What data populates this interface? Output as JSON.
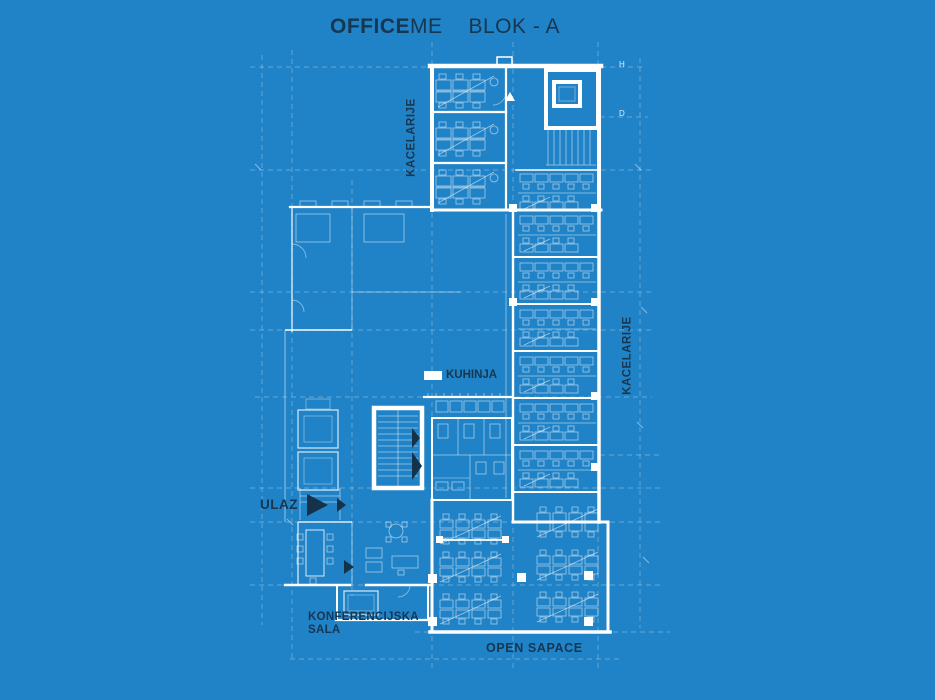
{
  "title": {
    "brand_bold": "OFFICE",
    "brand_regular": "ME",
    "block_name": "BLOK - A"
  },
  "labels": {
    "offices_top": "KACELARIJE",
    "offices_right": "KACELARIJE",
    "kitchen": "KUHINJA",
    "entrance": "ULAZ",
    "conference_room": "KONFERENCIJSKA\nSALA",
    "open_space": "OPEN SAPACE"
  },
  "grid_axis_labels": {
    "right_top": "H",
    "right_middle": "D"
  },
  "icons": {
    "entrance_arrow": "right-triangle"
  },
  "colors": {
    "background": "#2183c7",
    "ink_text": "#17364f",
    "line_strong": "#ffffff",
    "line_faint": "rgba(255,255,255,0.58)",
    "grid_line": "rgba(255,255,255,0.30)"
  }
}
